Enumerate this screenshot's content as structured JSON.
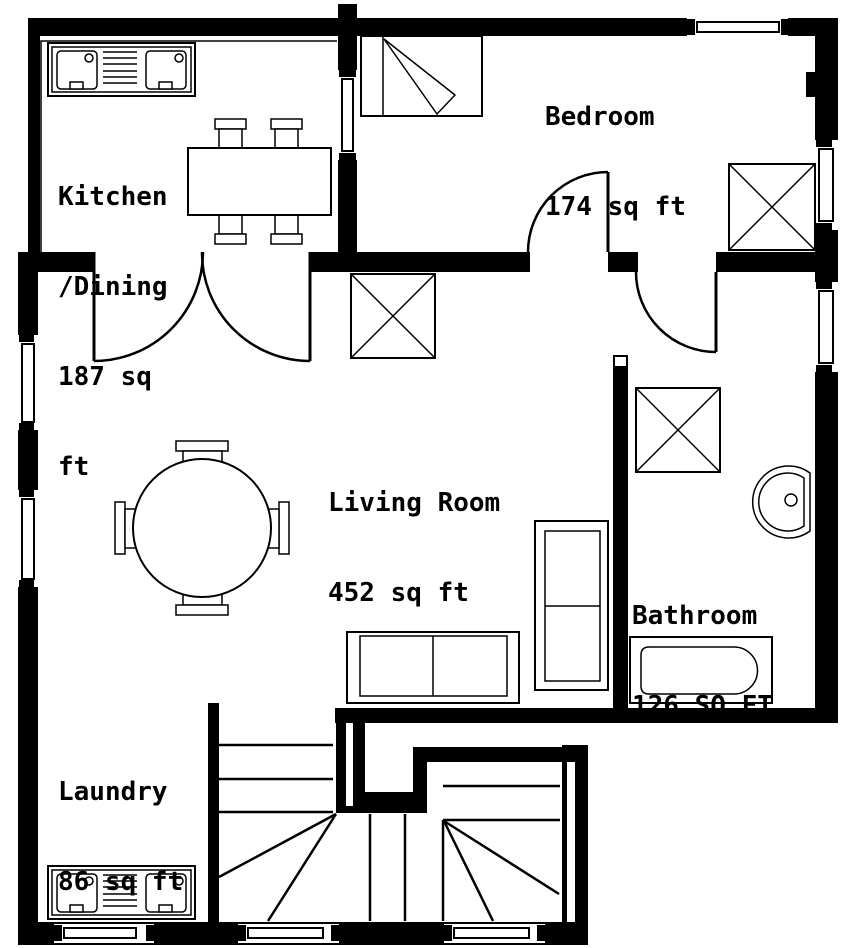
{
  "title": "Apartment floor plan",
  "colors": {
    "wall": "#000000",
    "background": "#ffffff",
    "line": "#000000"
  },
  "rooms": [
    {
      "id": "kitchen-dining",
      "name": "Kitchen/Dining",
      "area_sq_ft": 187,
      "label_lines": [
        "Kitchen",
        "/Dining",
        "187 sq",
        "ft"
      ]
    },
    {
      "id": "bedroom",
      "name": "Bedroom",
      "area_sq_ft": 174,
      "label_lines": [
        "Bedroom",
        "174 sq ft"
      ]
    },
    {
      "id": "living-room",
      "name": "Living Room",
      "area_sq_ft": 452,
      "label_lines": [
        "Living Room",
        "452 sq ft"
      ]
    },
    {
      "id": "bathroom",
      "name": "Bathroom",
      "area_sq_ft": 126,
      "label_lines": [
        "Bathroom",
        "126 SQ FT"
      ]
    },
    {
      "id": "laundry",
      "name": "Laundry",
      "area_sq_ft": 86,
      "label_lines": [
        "Laundry",
        "86 sq ft"
      ]
    }
  ],
  "fixtures": [
    "kitchen-sink-unit",
    "dining-table",
    "dining-chairs",
    "double-bed",
    "bedroom-closet",
    "living-room-closet",
    "bathroom-shower",
    "wash-basin",
    "bathtub",
    "round-table",
    "round-table-chairs",
    "sofa",
    "couch",
    "laundry-sink-unit",
    "u-shaped-staircase",
    "double-swing-door",
    "bedroom-door",
    "bathroom-door",
    "windows"
  ]
}
